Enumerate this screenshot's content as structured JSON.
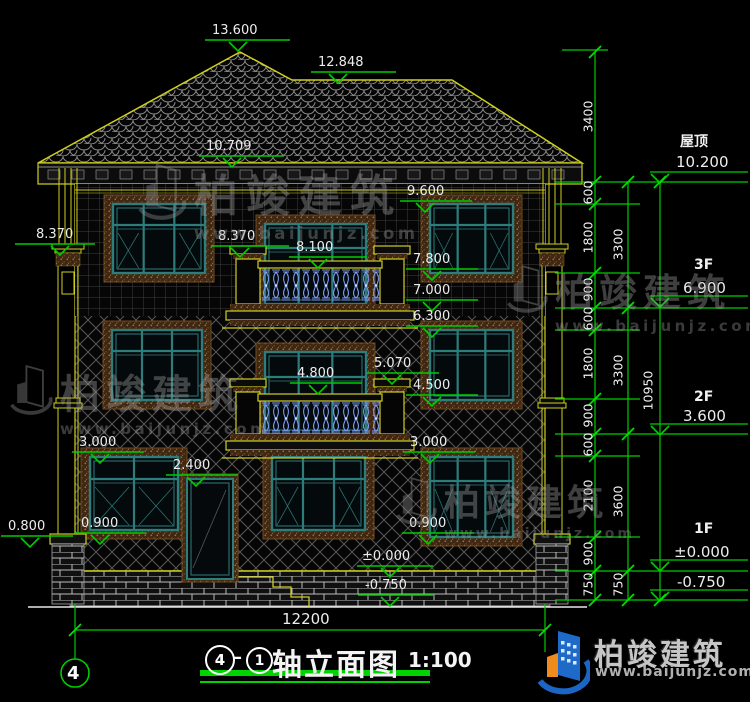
{
  "drawing_title": {
    "axis_start": "4",
    "axis_end": "1",
    "name": "轴立面图",
    "scale": "1:100"
  },
  "axis_bubble": "4",
  "overall_width": "12200",
  "elevation_markers": {
    "peak": "13.600",
    "ridge": "12.848",
    "eaves": "10.709",
    "f3_window_top": "9.600",
    "capital_left": "8.370",
    "capital_mid": "8.370",
    "f3_rail": "8.100",
    "f3_window_bottom": "7.800",
    "f3_balcony_floor": "7.000",
    "f2_window_top": "6.300",
    "f2_mid": "5.070",
    "f2_rail": "4.800",
    "f2_window_bottom": "4.500",
    "f1_window_top_left": "3.000",
    "f1_door_top": "2.400",
    "f1_window_top_right": "3.000",
    "f1_sill_left": "0.900",
    "plinth": "0.800",
    "f1_sill_right": "0.900",
    "ground": "±0.000",
    "below_ground": "-0.750"
  },
  "floor_labels": [
    {
      "name": "屋顶",
      "value": "10.200"
    },
    {
      "name": "3F",
      "value": "6.900"
    },
    {
      "name": "2F",
      "value": "3.600"
    },
    {
      "name": "1F",
      "value": "±0.000"
    },
    {
      "name": "",
      "value": "-0.750"
    }
  ],
  "dimensions": {
    "chain_inner": [
      "3400",
      "600",
      "1800",
      "900",
      "600",
      "1800",
      "900",
      "600",
      "2100",
      "900",
      "750"
    ],
    "chain_mid": [
      "3300",
      "3300",
      "3600",
      "750"
    ],
    "chain_outer": [
      "10950"
    ],
    "width": "12200"
  },
  "watermark": {
    "company": "柏竣建筑",
    "url": "www.baijunjz.com"
  },
  "logo": {
    "company": "柏竣建筑",
    "url": "www.baijunjz.com"
  },
  "colors": {
    "dimension_green": "#00cc00",
    "outline_yellow": "#cfcf1f",
    "window_teal": "#2e7d7d",
    "baluster_blue": "#7d9bef",
    "logo_blue": "#1b66c4",
    "logo_orange": "#ef8b1d"
  }
}
